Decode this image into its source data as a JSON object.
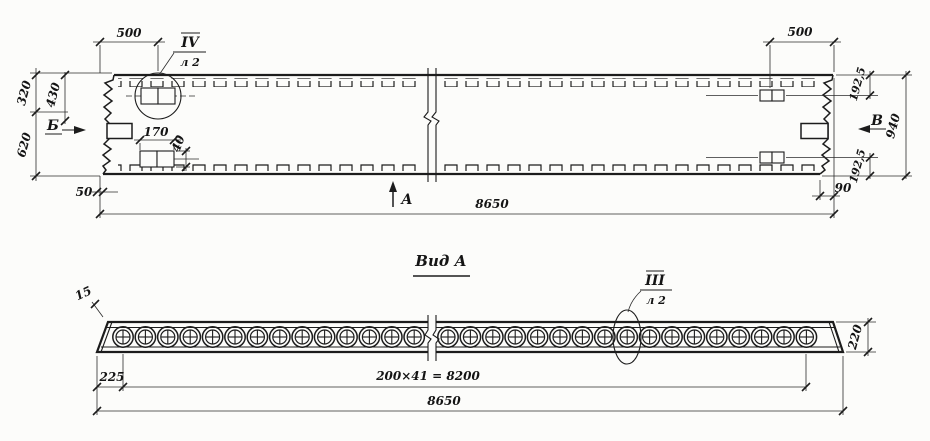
{
  "colors": {
    "paper": "#fcfcfa",
    "ink": "#1c1c1c"
  },
  "top_view": {
    "dim_500_left": "500",
    "dim_500_right": "500",
    "dim_320": "320",
    "dim_430": "430",
    "dim_620": "620",
    "dim_50": "50",
    "dim_170": "170",
    "dim_40": "40",
    "dim_8650": "8650",
    "dim_192_5_top": "192,5",
    "dim_192_5_bottom": "192,5",
    "dim_940": "940",
    "dim_90": "90",
    "section_left": "Б",
    "section_right": "В",
    "view_arrow": "А",
    "detail_callout": {
      "numeral": "IV",
      "sheet": "л 2"
    }
  },
  "bottom_view": {
    "title": "Вид А",
    "dim_15": "15",
    "dim_225": "225",
    "dim_spacing": "200×41 = 8200",
    "dim_8650": "8650",
    "dim_220": "220",
    "detail_callout": {
      "numeral": "III",
      "sheet": "л 2"
    }
  }
}
